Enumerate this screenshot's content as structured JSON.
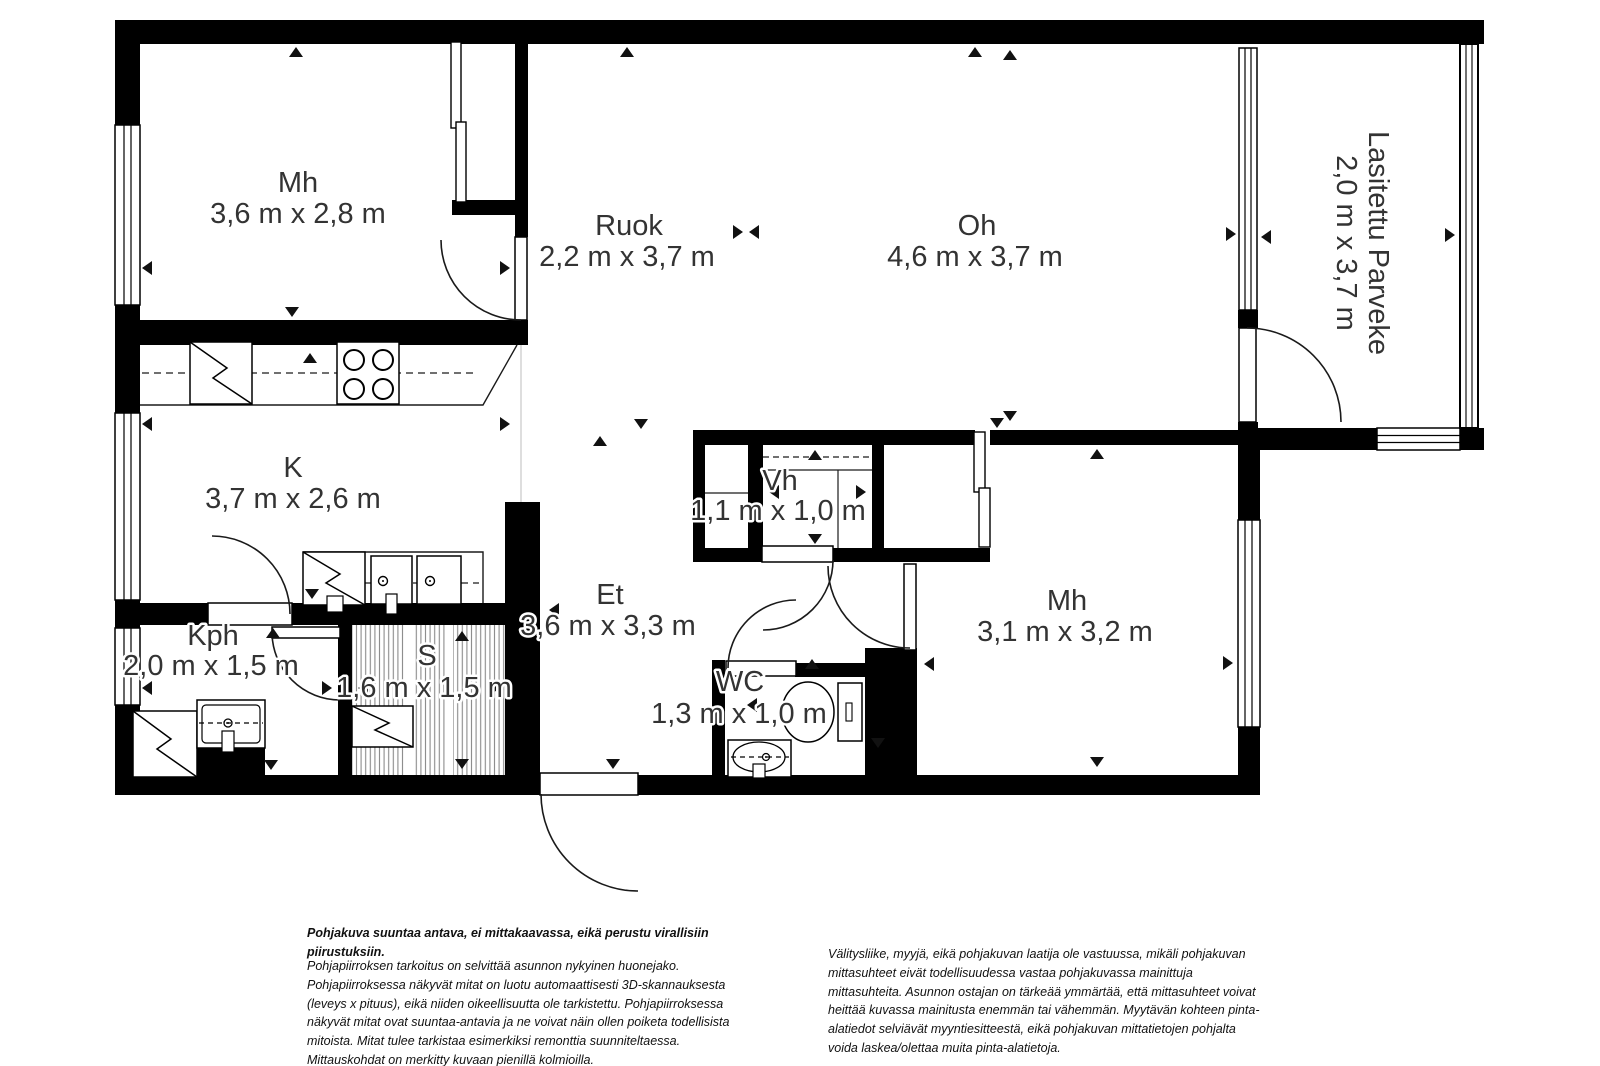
{
  "rooms": {
    "mh1": {
      "name": "Mh",
      "dims": "3,6 m x 2,8 m"
    },
    "ruok": {
      "name": "Ruok",
      "dims": "2,2 m x 3,7 m"
    },
    "oh": {
      "name": "Oh",
      "dims": "4,6 m x 3,7 m"
    },
    "parveke": {
      "name": "Lasitettu Parveke",
      "dims": "2,0 m x 3,7 m"
    },
    "k": {
      "name": "K",
      "dims": "3,7 m x 2,6 m"
    },
    "vh": {
      "name": "Vh",
      "dims": "1,1 m x 1,0 m"
    },
    "et": {
      "name": "Et",
      "dims": "3,6 m x 3,3 m"
    },
    "mh2": {
      "name": "Mh",
      "dims": "3,1 m x 3,2 m"
    },
    "kph": {
      "name": "Kph",
      "dims": "2,0 m x 1,5 m"
    },
    "s": {
      "name": "S",
      "dims": "1,6 m x 1,5 m"
    },
    "wc": {
      "name": "WC",
      "dims": "1,3 m x 1,0 m"
    }
  },
  "disclaimers": {
    "left_bold": "Pohjakuva suuntaa antava, ei mittakaavassa, eikä perustu virallisiin piirustuksiin.",
    "left_body": "Pohjapiirroksen tarkoitus on selvittää asunnon nykyinen huonejako. Pohjapiirroksessa näkyvät mitat on luotu automaattisesti 3D-skannauksesta (leveys x pituus), eikä niiden oikeellisuutta ole tarkistettu. Pohjapiirroksessa näkyvät mitat ovat suuntaa-antavia ja ne voivat näin ollen poiketa todellisista mitoista. Mitat tulee tarkistaa esimerkiksi remonttia suunniteltaessa. Mittauskohdat on merkitty kuvaan pienillä kolmioilla.",
    "right_body": "Välitysliike, myyjä, eikä pohjakuvan laatija ole vastuussa, mikäli pohjakuvan mittasuhteet eivät todellisuudessa vastaa pohjakuvassa mainittuja mittasuhteita. Asunnon ostajan on tärkeää ymmärtää, että mittasuhteet voivat heittää kuvassa mainitusta enemmän tai vähemmän. Myytävän kohteen pinta-alatiedot selviävät myyntiesitteestä, eikä pohjakuvan mittatietojen pohjalta voida laskea/olettaa muita pinta-alatietoja.",
    "left_bold_color": "#111111"
  },
  "fixtures": [
    "fridge",
    "stove",
    "dishwasher",
    "kitchen-sink",
    "washing-machine",
    "bathroom-sink",
    "sauna-heater",
    "toilet",
    "wc-sink",
    "wardrobe-sliding-doors"
  ],
  "colors": {
    "wall": "#000000",
    "line": "#1a1a1a",
    "label_text": "#333333",
    "sauna_stripe": "#8a8a8a"
  }
}
